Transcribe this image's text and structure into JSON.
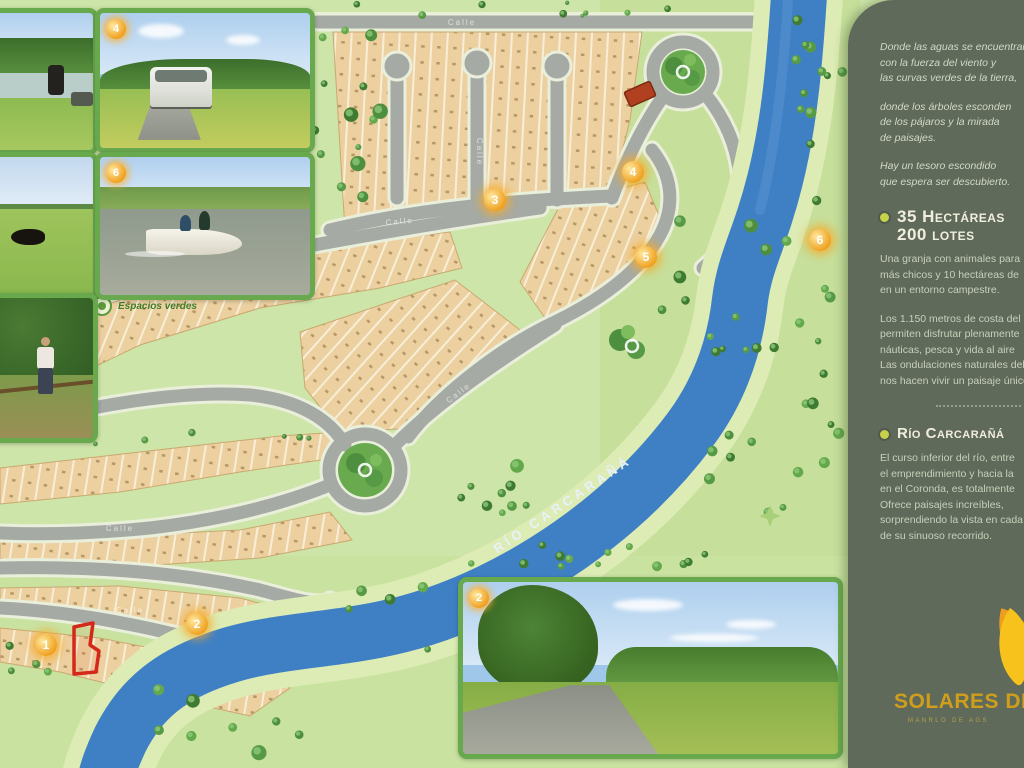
{
  "map": {
    "river_label": "Río Carcarañá",
    "legend": "Espacios verdes",
    "road_label": "Calle",
    "badges": [
      {
        "n": "1",
        "x": 46,
        "y": 645
      },
      {
        "n": "2",
        "x": 197,
        "y": 624
      },
      {
        "n": "3",
        "x": 495,
        "y": 200
      },
      {
        "n": "4",
        "x": 633,
        "y": 172
      },
      {
        "n": "5",
        "x": 646,
        "y": 257
      },
      {
        "n": "6",
        "x": 820,
        "y": 240
      }
    ]
  },
  "photos": [
    {
      "name": "lake-shore"
    },
    {
      "name": "car-on-country-road",
      "badge": "4"
    },
    {
      "name": "green-field-cattle"
    },
    {
      "name": "boat-on-river",
      "badge": "6"
    },
    {
      "name": "person-at-fence"
    },
    {
      "name": "grove-and-path",
      "badge": "2"
    }
  ],
  "sidebar": {
    "bg": "#5f6a5b",
    "accent": "#c5d24a",
    "intro_paragraphs": [
      "Donde las aguas se encuentran\ncon la fuerza del viento y\nlas curvas verdes de la tierra,",
      "donde los árboles esconden\nde los pájaros y la mirada\nde paisajes.",
      "Hay un tesoro escondido\nque espera ser descubierto."
    ],
    "section1": {
      "title_line1": "35 Hectáreas",
      "title_line2": "200 lotes",
      "paragraphs": [
        "Una granja con animales para\nmás chicos y 10 hectáreas de\nen un entorno campestre.",
        "Los 1.150 metros de costa del\npermiten disfrutar plenamente\nnáuticas, pesca y vida al aire\nLas ondulaciones naturales del\nnos hacen vivir un paisaje único."
      ]
    },
    "section2": {
      "title": "Río Carcarañá",
      "paragraphs": [
        "El curso inferior del río, entre\nel emprendimiento y hacia la\nen el Coronda, es totalmente\nOfrece paisajes increíbles,\nsorprendiendo la vista en cada\nde su sinuoso recorrido."
      ]
    },
    "logo": {
      "name": "Solares del",
      "sub": "Manrlo de Ags"
    }
  }
}
